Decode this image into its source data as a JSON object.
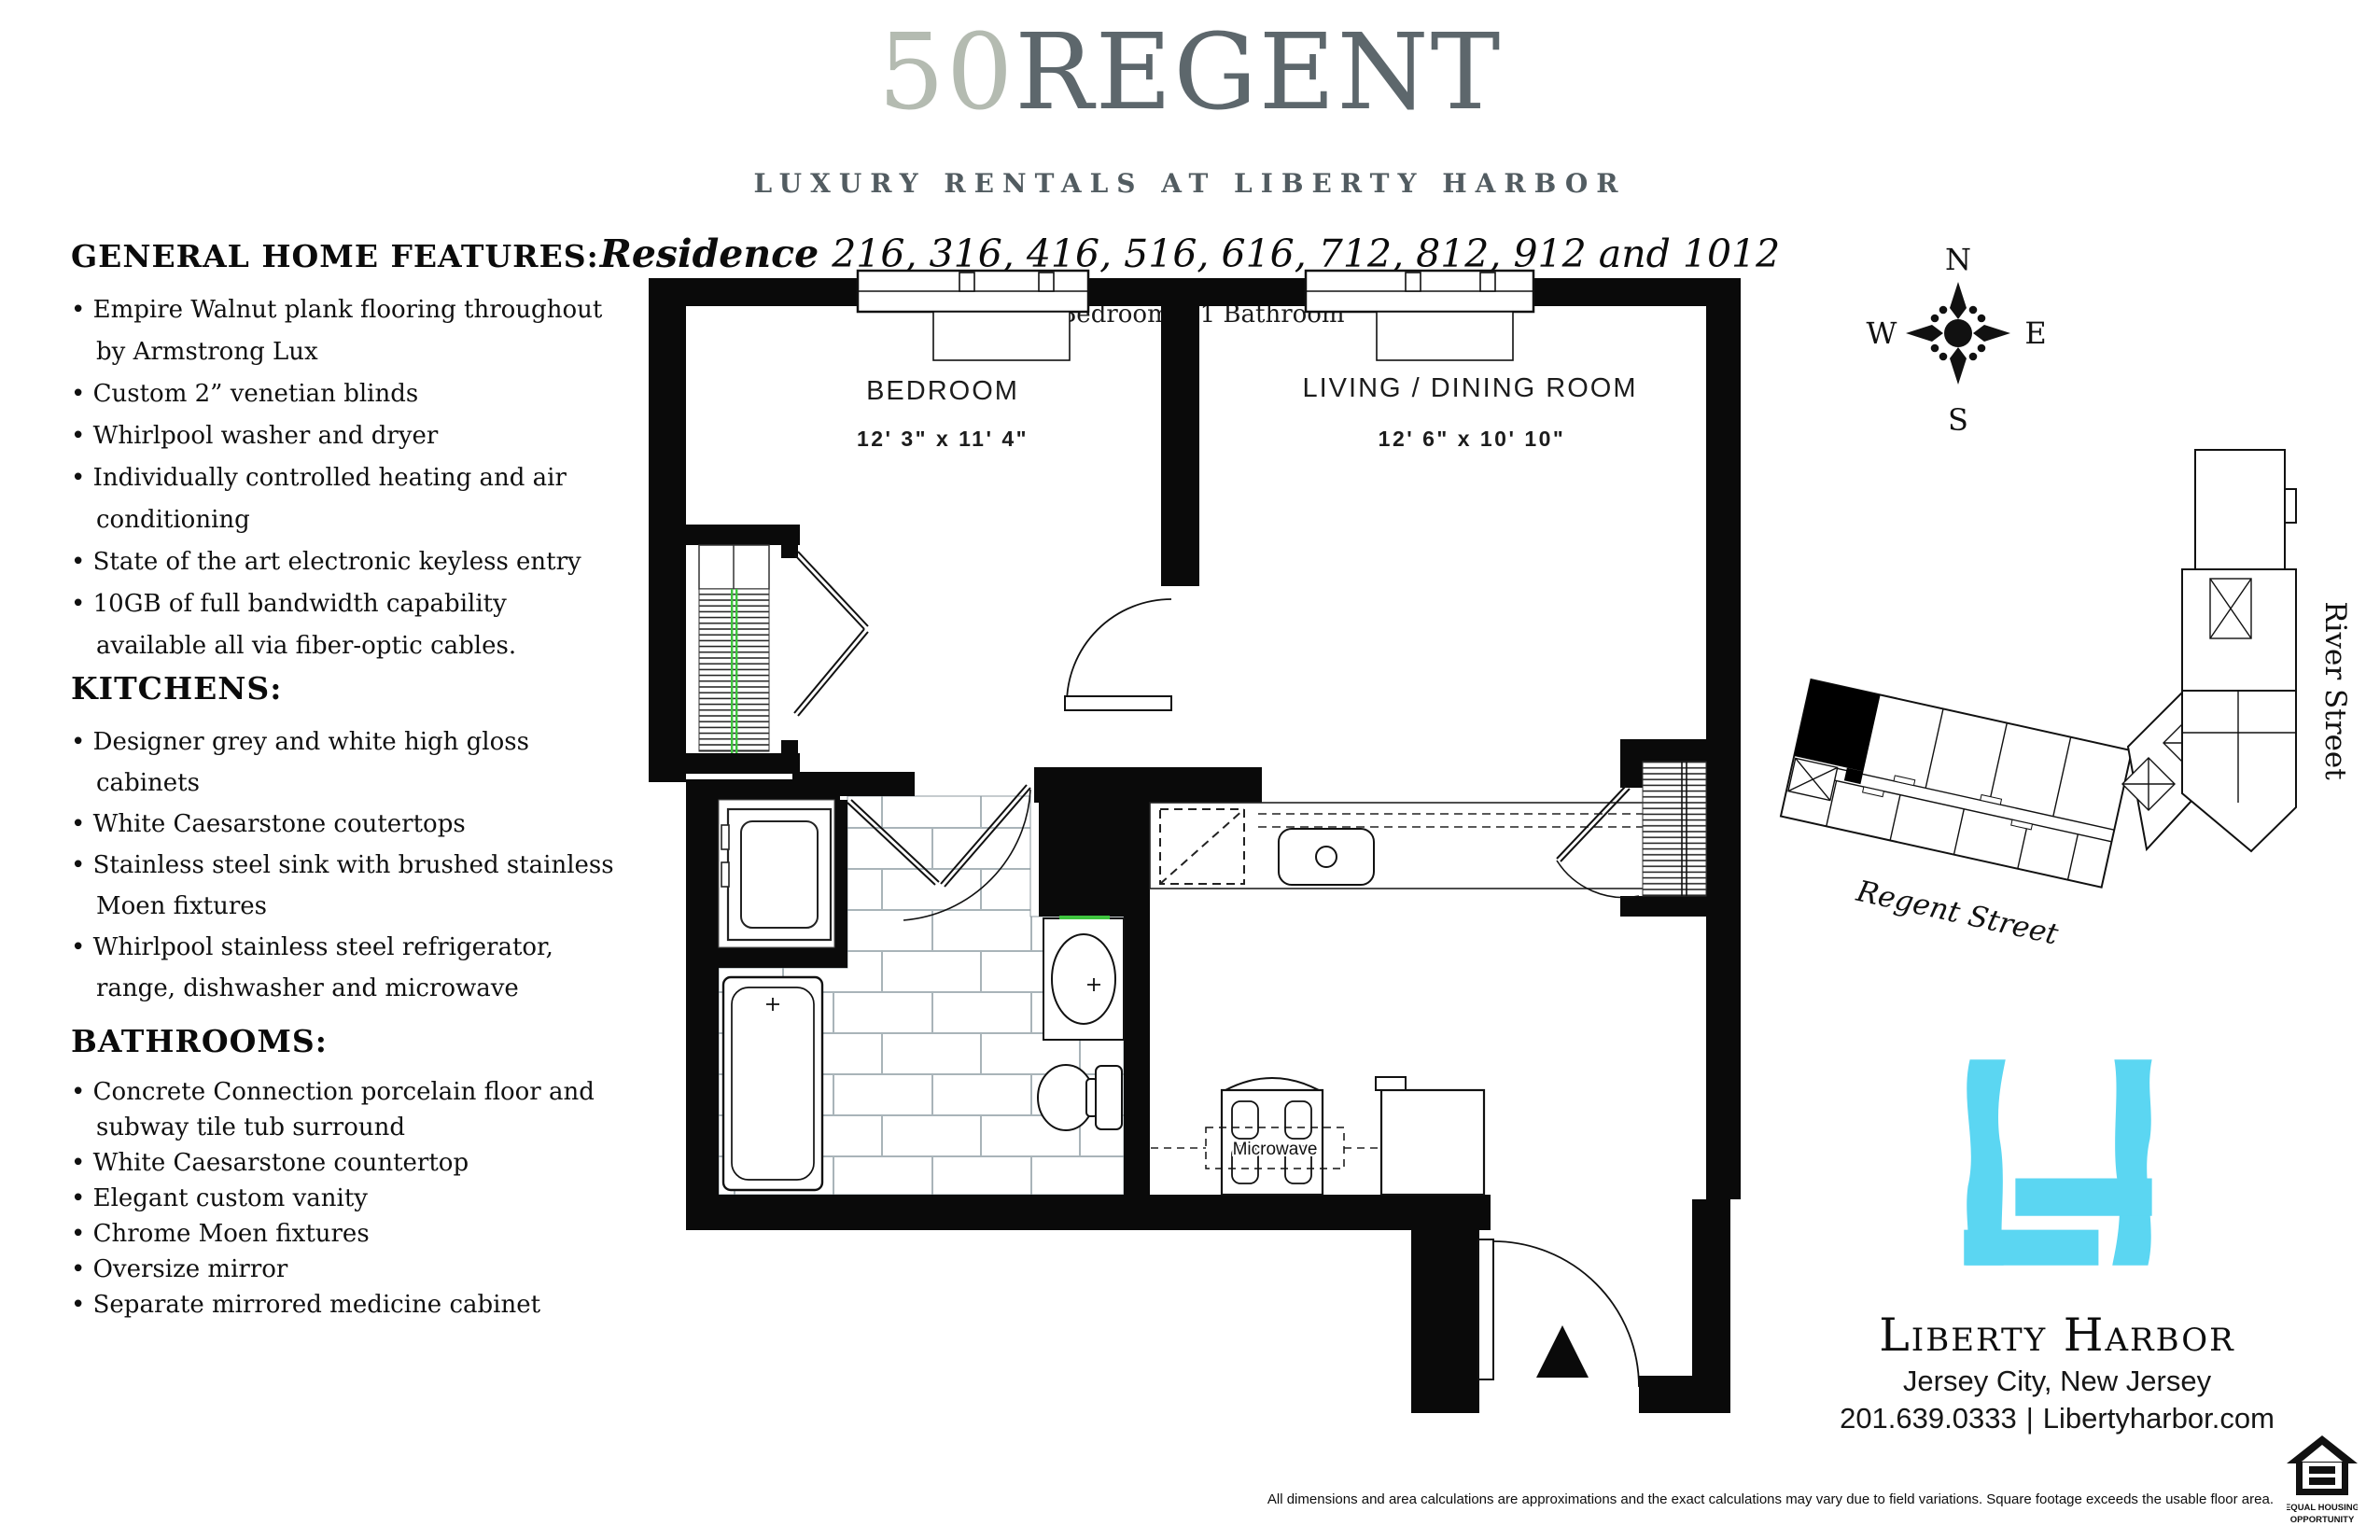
{
  "header": {
    "building_number": "50",
    "building_name": "REGENT",
    "subtitle": "LUXURY RENTALS AT LIBERTY HARBOR",
    "residence_label": "Residence",
    "residence_numbers": "216, 316, 416, 516, 616, 712, 812, 912 and 1012",
    "configuration": "1 Bedroom • 1 Bathroom"
  },
  "features": {
    "sections": [
      {
        "title": "GENERAL HOME FEATURES:",
        "items": [
          "Empire Walnut plank flooring throughout by Armstrong Lux",
          "Custom 2” venetian blinds",
          "Whirlpool washer and dryer",
          "Individually controlled heating and air conditioning",
          "State of the art electronic keyless entry",
          "10GB of full bandwidth capability available all via fiber-optic cables."
        ]
      },
      {
        "title": "KITCHENS:",
        "items": [
          "Designer grey and white high gloss cabinets",
          "White Caesarstone coutertops",
          "Stainless steel sink with brushed stainless Moen fixtures",
          "Whirlpool stainless steel refrigerator, range, dishwasher and microwave"
        ]
      },
      {
        "title": "BATHROOMS:",
        "items": [
          "Concrete Connection porcelain floor and subway tile tub surround",
          "White Caesarstone countertop",
          "Elegant custom vanity",
          "Chrome Moen fixtures",
          "Oversize mirror",
          "Separate mirrored medicine cabinet"
        ]
      }
    ]
  },
  "floor_plan": {
    "bedroom_label": "BEDROOM",
    "bedroom_dims": "12' 3\" x  11' 4\"",
    "living_label": "LIVING / DINING ROOM",
    "living_dims": "12' 6\" x  10' 10\"",
    "microwave_label": "Microwave"
  },
  "compass": {
    "north": "N",
    "south": "S",
    "east": "E",
    "west": "W"
  },
  "site_plan": {
    "street_bottom": "Regent Street",
    "street_right": "River Street"
  },
  "footer": {
    "brand": "Liberty Harbor",
    "location": "Jersey City, New Jersey",
    "phone": "201.639.0333",
    "separator": "|",
    "website": "Libertyharbor.com",
    "disclaimer": "All dimensions and area calculations are approximations and the exact calculations may vary due to field variations. Square footage exceeds the usable floor area.",
    "equal_housing_line1": "EQUAL HOUSING",
    "equal_housing_line2": "OPPORTUNITY"
  },
  "colors": {
    "wall": "#0a0a0a",
    "title_number": "#b4bbb1",
    "title_name": "#5d676c",
    "logo_cyan": "#5bd6f2",
    "closet_rod_green": "#3ec43e",
    "tile_line": "#a9b4b9"
  }
}
